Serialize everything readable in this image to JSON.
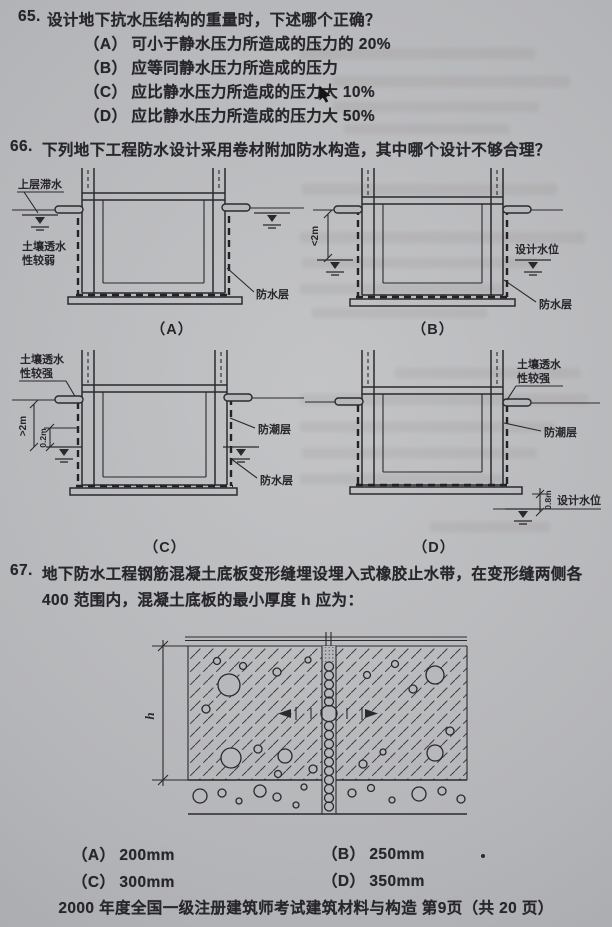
{
  "page": {
    "paper_color": "#b7b8bb",
    "ink_color": "#26262b",
    "footer": "2000 年度全国一级注册建筑师考试建筑材料与构造 第9页（共 20 页）"
  },
  "q65": {
    "number": "65.",
    "question": "设计地下抗水压结构的重量时，下述哪个正确？",
    "options": [
      {
        "label": "（A）",
        "text": "可小于静水压力所造成的压力的 20%"
      },
      {
        "label": "（B）",
        "text": "应等同静水压力所造成的压力"
      },
      {
        "label": "（C）",
        "text": "应比静水压力所造成的压力大 10%"
      },
      {
        "label": "（D）",
        "text": "应比静水压力所造成的压力大 50%"
      }
    ]
  },
  "q66": {
    "number": "66.",
    "question": "下列地下工程防水设计采用卷材附加防水构造，其中哪个设计不够合理？",
    "diagrams": {
      "a": {
        "caption": "（A）",
        "perched_water": "上层滞水",
        "soil_line1": "土壤透水",
        "soil_line2": "性较弱",
        "waterproof_layer": "防水层"
      },
      "b": {
        "caption": "（B）",
        "depth_dim": "<2m",
        "design_water_level": "设计水位",
        "waterproof_layer": "防水层"
      },
      "c": {
        "caption": "（C）",
        "soil_line1": "土壤透水",
        "soil_line2": "性较强",
        "depth_dim": ">2m",
        "offset_dim": "0.2m",
        "dampproof_layer": "防潮层",
        "waterproof_layer": "防水层"
      },
      "d": {
        "caption": "（D）",
        "soil_line1": "土壤透水",
        "soil_line2": "性较强",
        "dampproof_layer": "防潮层",
        "depth_dim": "0.8m",
        "design_water_level": "设计水位"
      }
    }
  },
  "q67": {
    "number": "67.",
    "question_line1": "地下防水工程钢筋混凝土底板变形缝埋设埋入式橡胶止水带，在变形缝两侧各",
    "question_line2": "400 范围内，混凝土底板的最小厚度 h 应为：",
    "thickness_dim": "h",
    "options": [
      {
        "label": "（A）",
        "text": "200mm"
      },
      {
        "label": "（B）",
        "text": "250mm"
      },
      {
        "label": "（C）",
        "text": "300mm"
      },
      {
        "label": "（D）",
        "text": "350mm"
      }
    ]
  }
}
